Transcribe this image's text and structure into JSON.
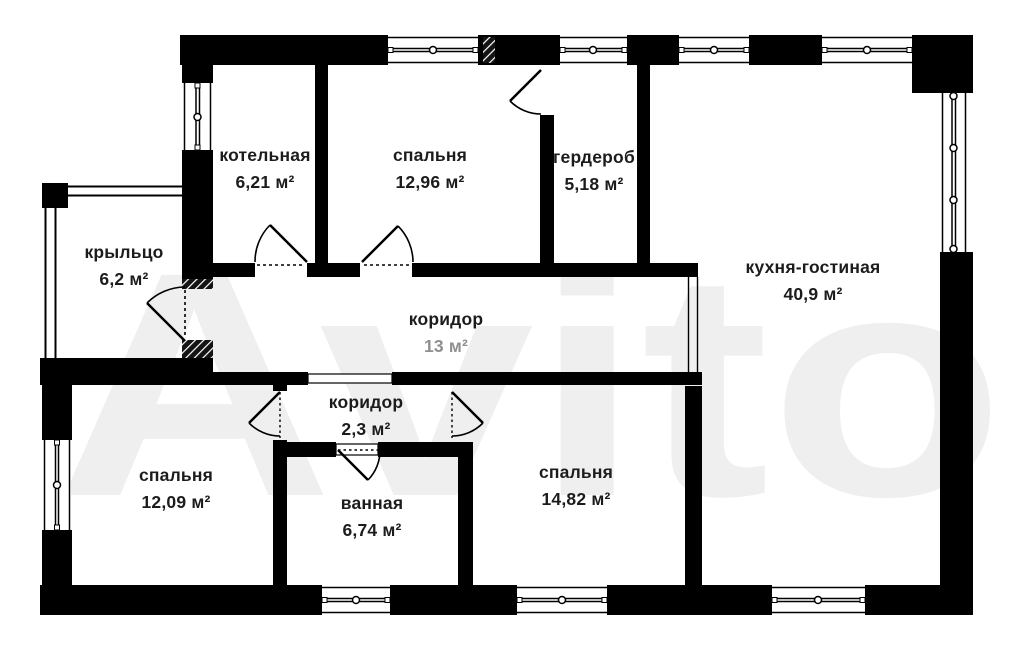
{
  "plan_title": "house floor plan",
  "watermark": "Avito",
  "colors": {
    "wall": "#000000",
    "text": "#1c1c1c",
    "watermark": "#efefef",
    "background": "#ffffff"
  },
  "rooms": [
    {
      "name": "котельная",
      "area": "6,21 м²"
    },
    {
      "name": "спальня",
      "area": "12,96 м²"
    },
    {
      "name": "гердероб",
      "area": "5,18 м²"
    },
    {
      "name": "кухня-гостиная",
      "area": "40,9 м²"
    },
    {
      "name": "крыльцо",
      "area": "6,2 м²"
    },
    {
      "name": "коридор",
      "area": "13 м²"
    },
    {
      "name": "коридор",
      "area": "2,3 м²"
    },
    {
      "name": "спальня",
      "area": "12,09 м²"
    },
    {
      "name": "ванная",
      "area": "6,74 м²"
    },
    {
      "name": "спальня",
      "area": "14,82 м²"
    }
  ]
}
